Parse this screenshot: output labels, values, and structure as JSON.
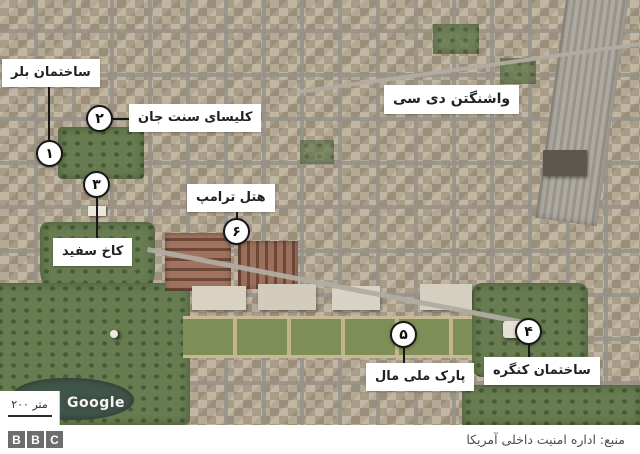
{
  "map": {
    "region_label": "واشنگتن دی سی",
    "attribution": "Google",
    "scale_label": "۲۰۰ متر",
    "markers": [
      {
        "number": "۱",
        "label": "ساختمان بلر"
      },
      {
        "number": "۲",
        "label": "کلیسای سنت جان"
      },
      {
        "number": "۳",
        "label": "کاخ سفید"
      },
      {
        "number": "۴",
        "label": "ساختمان کنگره"
      },
      {
        "number": "۵",
        "label": "پارک ملی مال"
      },
      {
        "number": "۶",
        "label": "هتل ترامپ"
      }
    ]
  },
  "footer": {
    "source": "منبع: اداره امنیت داخلی آمریکا",
    "logo_letters": [
      "B",
      "B",
      "C"
    ]
  },
  "colors": {
    "label_background": "#ffffff",
    "marker_outline": "#171717",
    "park_green": "#677c50",
    "water_green": "#41564a",
    "urban_tan": "#b2a58f",
    "bbc_gray": "#6d6d6d"
  }
}
